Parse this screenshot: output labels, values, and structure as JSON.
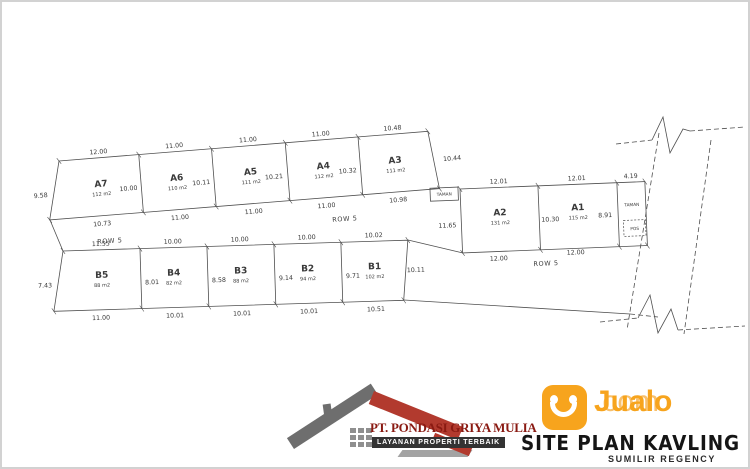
{
  "plan": {
    "row_label": "ROW 5",
    "garden_box": {
      "label": "TAMAN"
    },
    "garden_strip": {
      "label": "TAMAN",
      "top": "4.19",
      "pos": "POS"
    },
    "plots": [
      {
        "id": "A7",
        "area": "112 m2",
        "dims": {
          "top": "12.00",
          "bottom": "10.73",
          "left": "9.58",
          "right": "10.00"
        }
      },
      {
        "id": "A6",
        "area": "110 m2",
        "dims": {
          "top": "11.00",
          "bottom": "11.00",
          "right": "10.11"
        }
      },
      {
        "id": "A5",
        "area": "111 m2",
        "dims": {
          "top": "11.00",
          "bottom": "11.00",
          "right": "10.21"
        }
      },
      {
        "id": "A4",
        "area": "112 m2",
        "dims": {
          "top": "11.00",
          "bottom": "11.00",
          "right": "10.32"
        }
      },
      {
        "id": "A3",
        "area": "111 m2",
        "dims": {
          "top": "10.48",
          "bottom": "10.98",
          "right": "10.44"
        }
      },
      {
        "id": "A2",
        "area": "131 m2",
        "dims": {
          "top": "12.01",
          "bottom": "12.00",
          "left": "11.65",
          "right": "10.30"
        }
      },
      {
        "id": "A1",
        "area": "115 m2",
        "dims": {
          "top": "12.01",
          "bottom": "12.00",
          "right": "8.91"
        }
      },
      {
        "id": "B5",
        "area": "88 m2",
        "dims": {
          "top": "11.55",
          "bottom": "11.00",
          "left": "7.43",
          "right": "8.01"
        }
      },
      {
        "id": "B4",
        "area": "82 m2",
        "dims": {
          "top": "10.00",
          "bottom": "10.01",
          "right": "8.58"
        }
      },
      {
        "id": "B3",
        "area": "88 m2",
        "dims": {
          "top": "10.00",
          "bottom": "10.01",
          "right": "9.14"
        }
      },
      {
        "id": "B2",
        "area": "94 m2",
        "dims": {
          "top": "10.00",
          "bottom": "10.01",
          "right": "9.71"
        }
      },
      {
        "id": "B1",
        "area": "102 m2",
        "dims": {
          "top": "10.02",
          "bottom": "10.51",
          "right": "10.11"
        }
      }
    ]
  },
  "footer": {
    "company": {
      "name": "PT. PONDASI GRIYA MULIA",
      "tagline": "LAYANAN PROPERTI TERBAIK"
    },
    "brand": {
      "name": "Jualo",
      "suffix": ".com"
    },
    "plan_title": "SITE PLAN KAVLING",
    "plan_subtitle": "SUMILIR REGENCY"
  },
  "colors": {
    "accent_orange": "#F7A41D",
    "logo_maroon": "#8A1A12",
    "roof_red": "#B23A2E",
    "banner_dark": "#333333"
  }
}
